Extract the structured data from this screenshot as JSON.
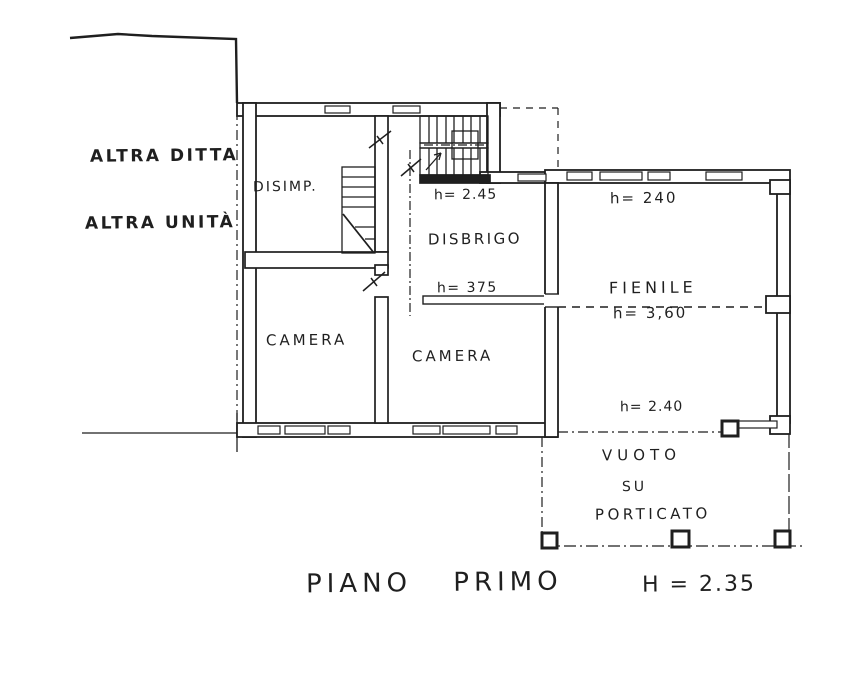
{
  "document": {
    "kind": "scanned floor plan drawing"
  },
  "colors": {
    "ink": "#1f1f1f",
    "paper": "#ffffff"
  },
  "annotations": {
    "altra_ditta": "ALTRA DITTA",
    "altra_unita": "ALTRA UNITÀ"
  },
  "rooms": {
    "disimp": "DISIMP.",
    "disbrigo": "DISBRIGO",
    "camera_left": "CAMERA",
    "camera_right": "CAMERA",
    "fienile": "FIENILE",
    "vuoto_line1": "VUOTO",
    "vuoto_line2": "SU",
    "vuoto_line3": "PORTICATO"
  },
  "heights": {
    "stair_landing": "h= 2.45",
    "fienile_north": "h= 240",
    "fienile_mid": "h= 3,60",
    "camera_beam": "h= 375",
    "porch_edge": "h= 2.40"
  },
  "title": {
    "floor": "PIANO PRIMO",
    "height": "H = 2.35"
  }
}
